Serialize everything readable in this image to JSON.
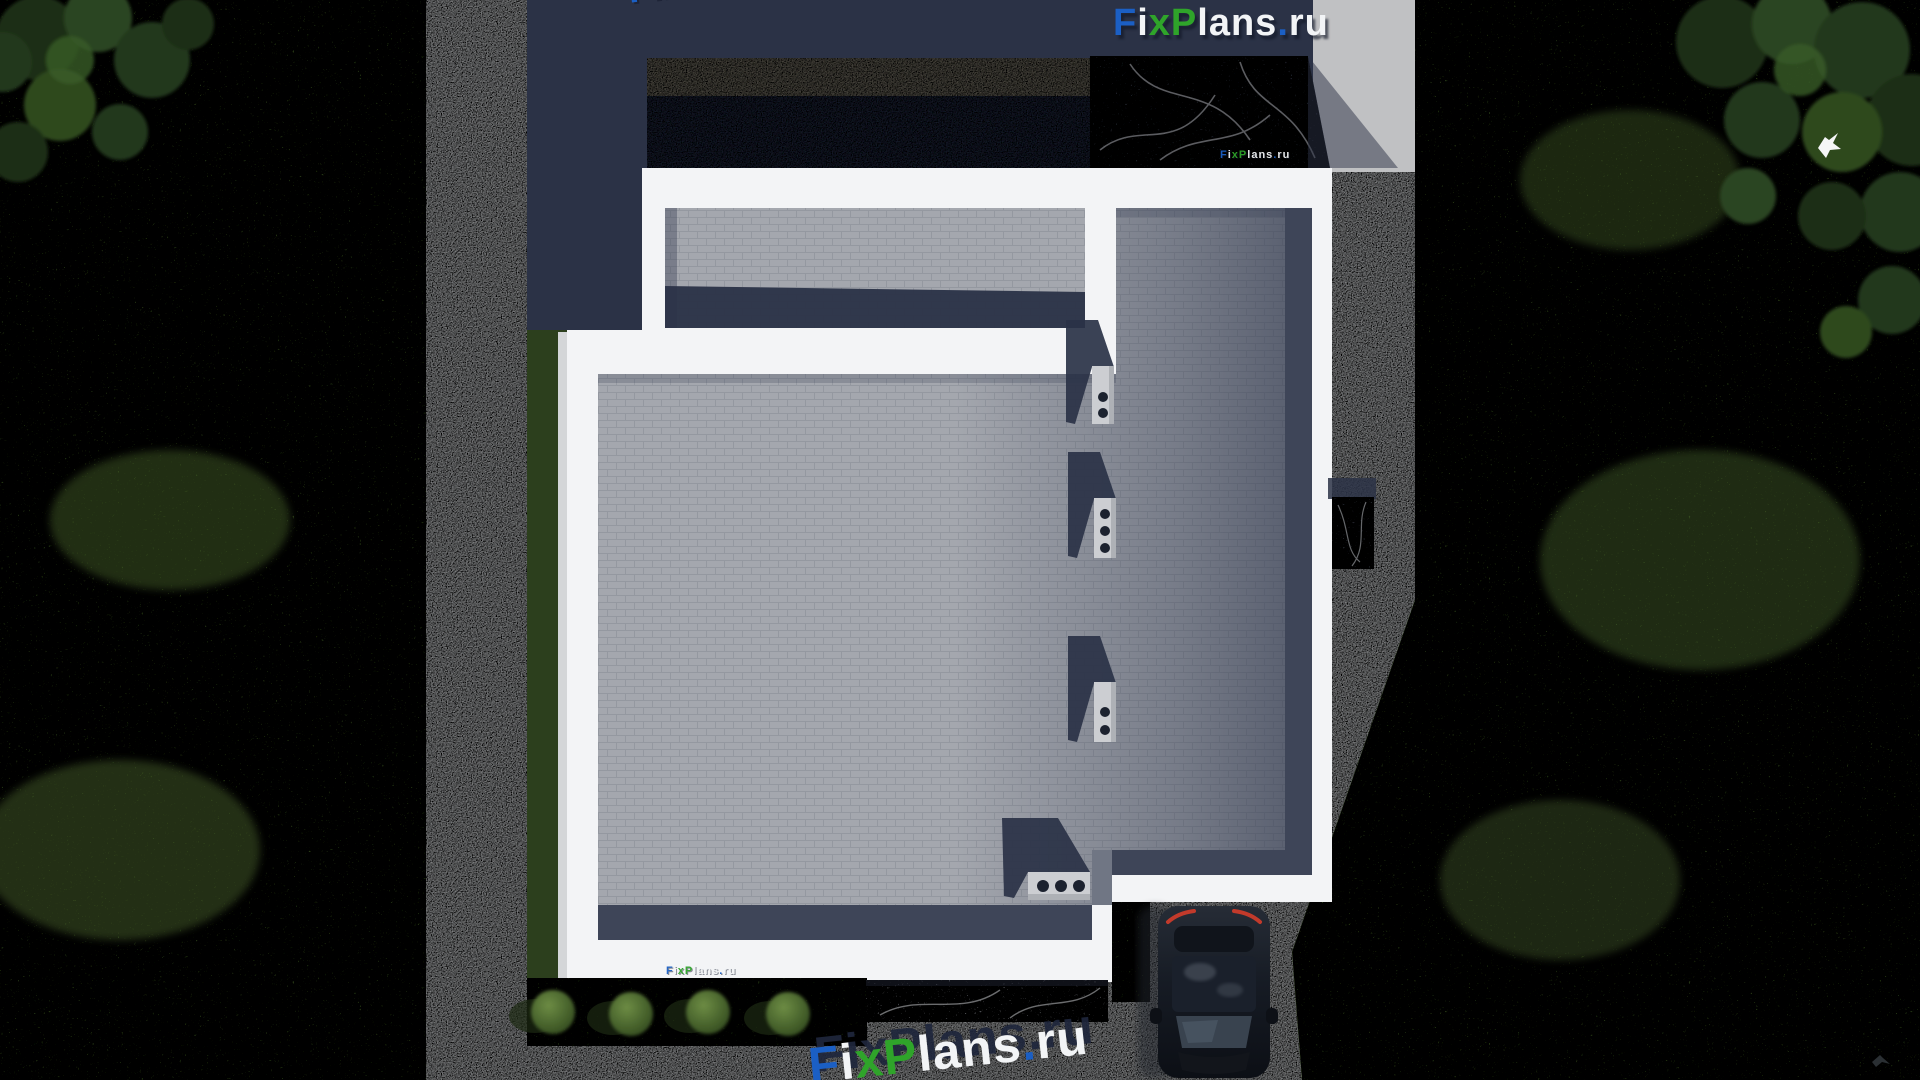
{
  "branding": {
    "name": "FixPlans.ru",
    "segments": [
      {
        "text": "F",
        "color": "#1b5fc4"
      },
      {
        "text": "i",
        "color": "#f2f4f6"
      },
      {
        "text": "x",
        "color": "#2fa42a"
      },
      {
        "text": "P",
        "color": "#2fa42a"
      },
      {
        "text": "lans",
        "color": "#f2f4f6"
      },
      {
        "text": ".",
        "color": "#1b5fc4"
      },
      {
        "text": "ru",
        "color": "#f2f4f6"
      }
    ]
  },
  "palette": {
    "grass": "#4d6a2f",
    "grass_shadow": "#2c3f1d",
    "concrete": "#b5b7b9",
    "roof_brick": "#a4a7ae",
    "roof_dark": "#232a3e",
    "parapet_white": "#f3f4f6",
    "shadow_navy": "#2b3246",
    "stone_slab": "#454c5a",
    "back_wall_band": "#6a665c",
    "car_body": "#12151c",
    "taillight_red": "#c23a2b",
    "tree_green": "#24381a"
  },
  "scene": {
    "counts": {
      "roof_chimneys": 4,
      "chimney_vents": [
        2,
        3,
        2,
        3
      ],
      "garden_bushes": 4,
      "cars": 1,
      "birds": 2
    }
  }
}
